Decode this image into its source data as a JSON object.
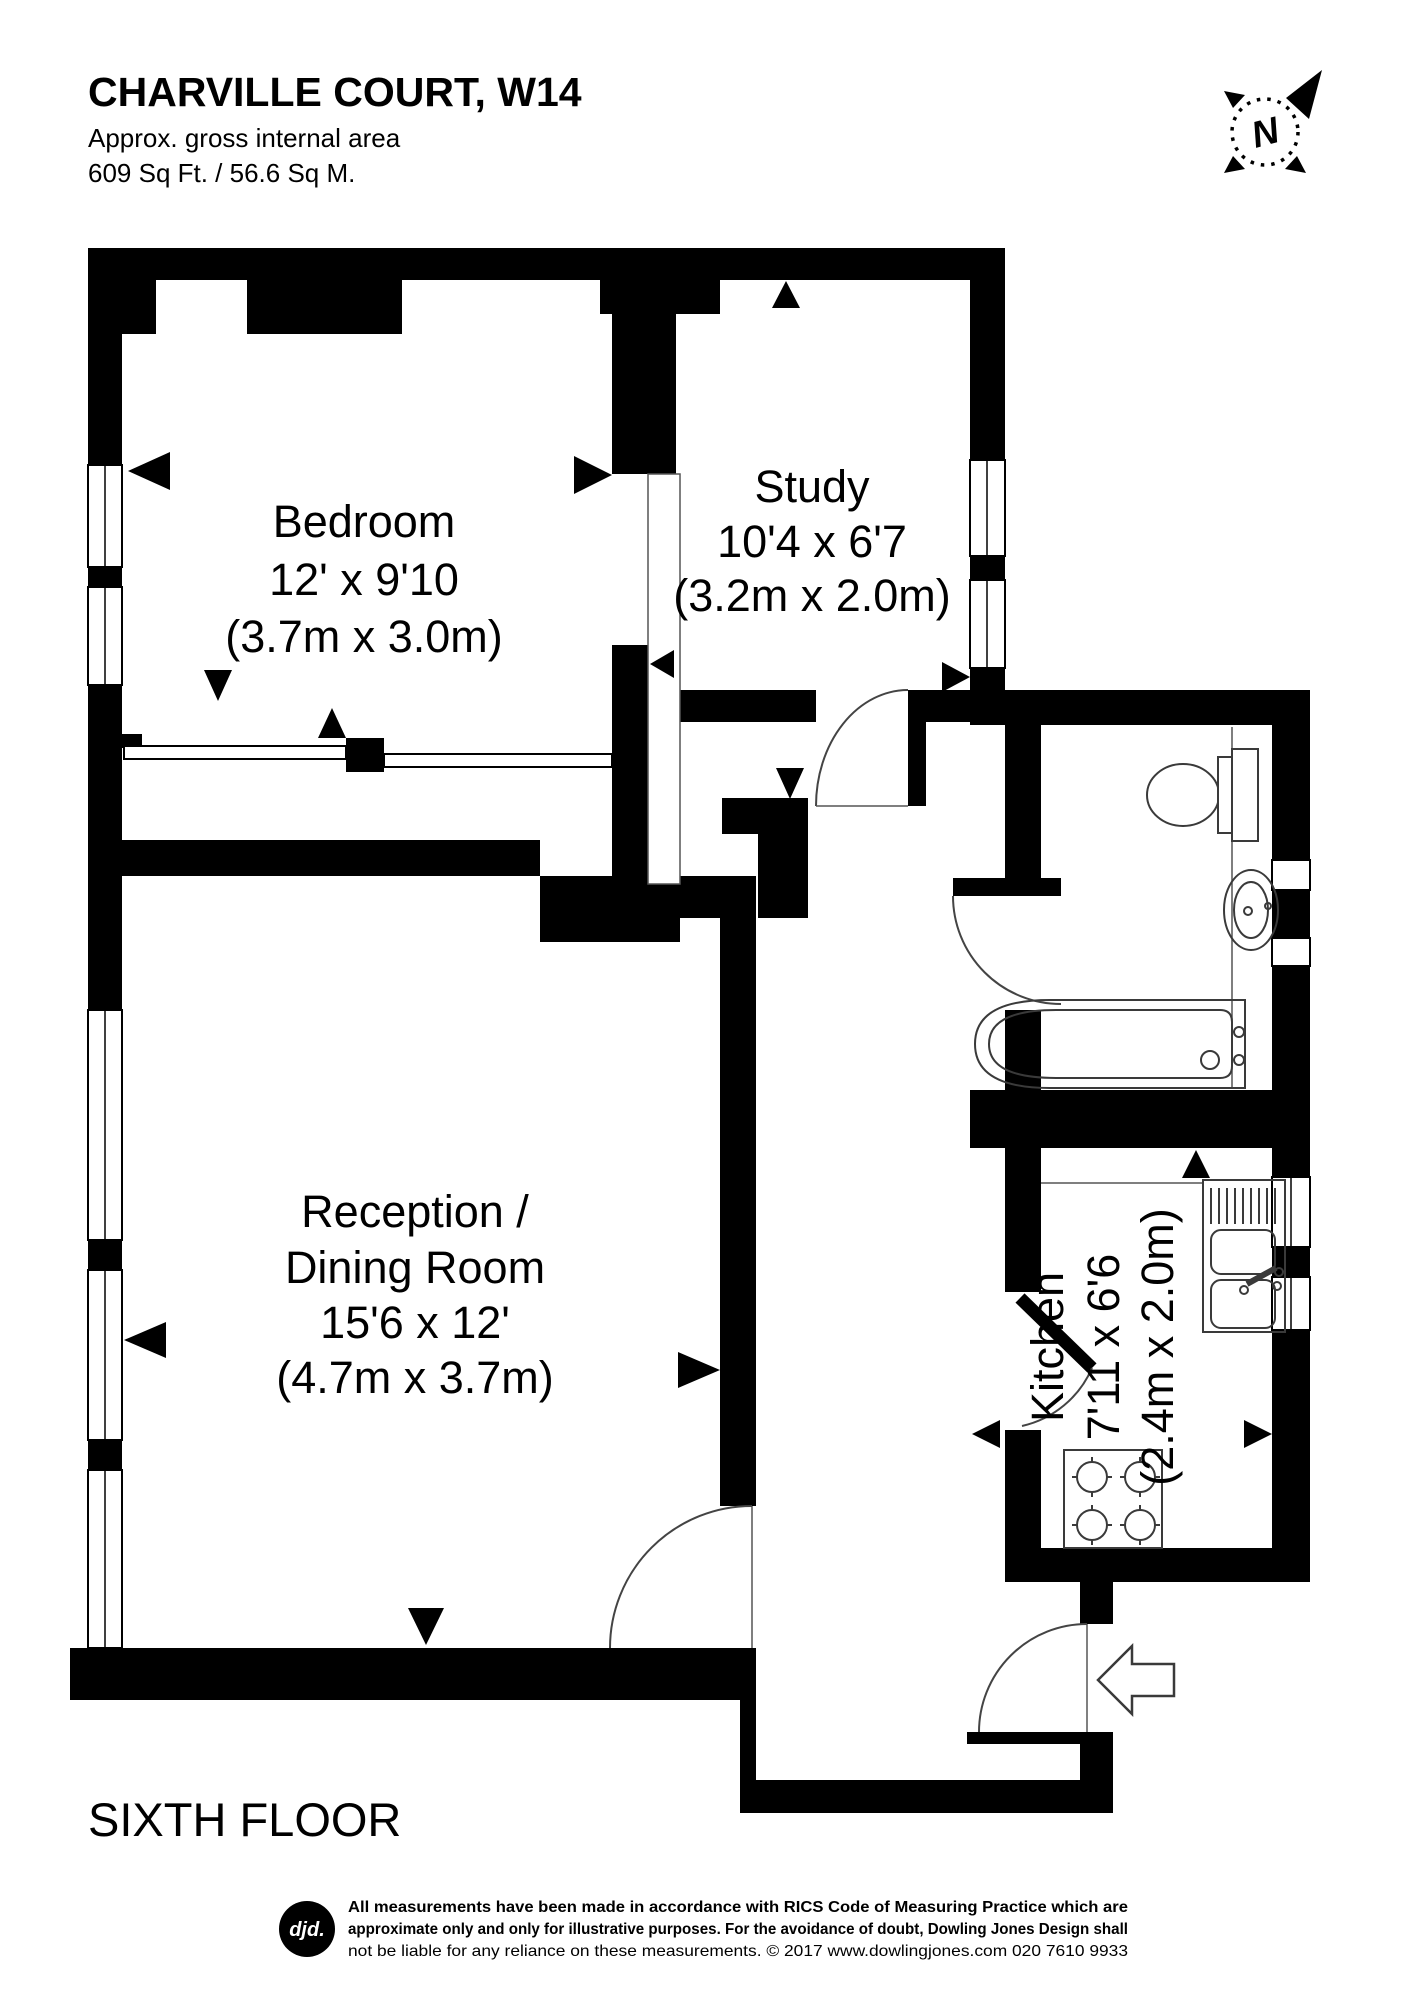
{
  "header": {
    "title": "CHARVILLE COURT, W14",
    "subtitle": "Approx. gross internal area",
    "area": "609 Sq Ft. / 56.6 Sq M."
  },
  "compass": {
    "north_label": "N"
  },
  "rooms": {
    "bedroom": {
      "name": "Bedroom",
      "dimensions_imperial": "12' x 9'10",
      "dimensions_metric": "(3.7m x 3.0m)"
    },
    "study": {
      "name": "Study",
      "dimensions_imperial": "10'4 x 6'7",
      "dimensions_metric": "(3.2m x 2.0m)"
    },
    "reception": {
      "name_line1": "Reception /",
      "name_line2": "Dining Room",
      "dimensions_imperial": "15'6 x 12'",
      "dimensions_metric": "(4.7m x 3.7m)"
    },
    "kitchen": {
      "name": "Kitchen",
      "dimensions_imperial": "7'11 x 6'6",
      "dimensions_metric": "(2.4m x 2.0m)"
    }
  },
  "floor_label": "SIXTH FLOOR",
  "footer": {
    "logo": "djd.",
    "disclaimer_line1": "All measurements have been made in accordance with RICS Code of Measuring Practice which are",
    "disclaimer_line2": "approximate only and only for illustrative purposes. For the avoidance of doubt, Dowling Jones Design shall",
    "disclaimer_line3": "not be liable for any reliance on these measurements. © 2017 www.dowlingjones.com 020 7610 9933"
  },
  "colors": {
    "wall": "#000000",
    "background": "#ffffff"
  }
}
